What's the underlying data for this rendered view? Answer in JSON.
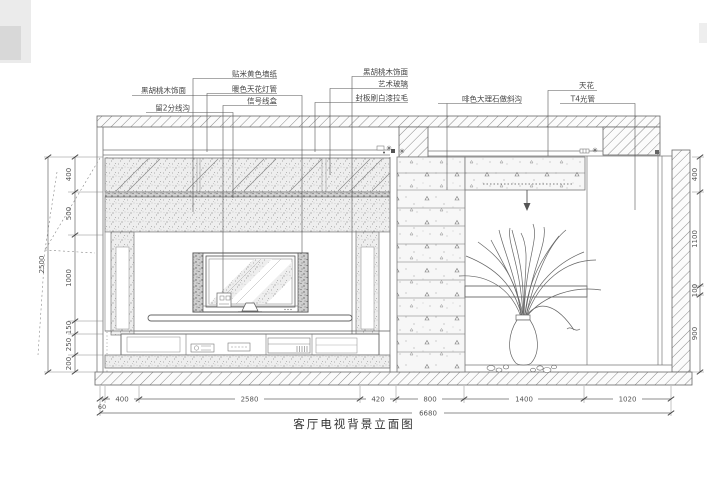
{
  "title": "客厅电视背景立面图",
  "callouts": {
    "c1": "黑胡桃木饰面",
    "c2": "留2分线沟",
    "c3": "贴米黄色墙纸",
    "c4": "暖色天花灯管",
    "c5": "信号线盒",
    "c6": "黑胡桃木饰面",
    "c7": "艺术玻璃",
    "c8": "封板刷白漆拉毛",
    "c9": "啡色大理石做斜沟",
    "c10": "天花",
    "c11": "T4光管"
  },
  "dims": {
    "left": [
      "400",
      "500",
      "1000",
      "150",
      "250",
      "200"
    ],
    "left_total": "2500",
    "right": [
      "400",
      "1100",
      "100",
      "900"
    ],
    "bottom": [
      "60",
      "400",
      "2580",
      "420",
      "800",
      "1400",
      "1020"
    ],
    "bottom_total": "6680"
  },
  "colors": {
    "line": "#666666",
    "paper": "#ffffff"
  }
}
